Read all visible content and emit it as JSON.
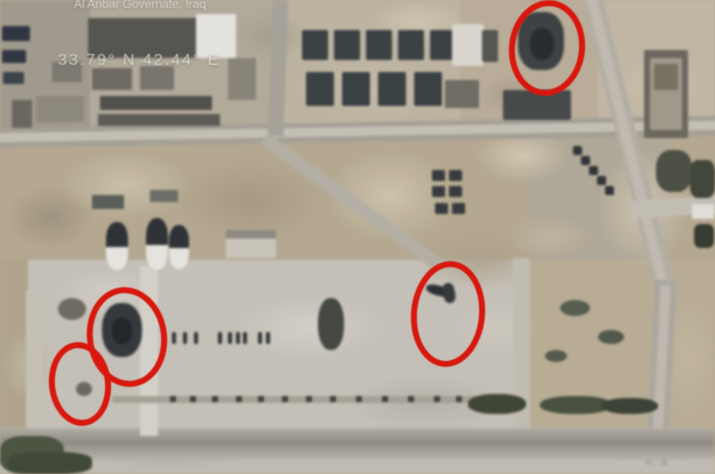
{
  "image": {
    "kind": "satellite-photo",
    "subject": "overhead view of an airbase with red circles marking damaged areas"
  },
  "overlay": {
    "location_caption": "Al Anbar Governate, Iraq",
    "coordinates_caption": "33.79° N 42.44° E"
  },
  "annotations": {
    "marker_shape": "ellipse",
    "marker_color": "#d8170e",
    "stroke_width_px": 6,
    "markers": [
      {
        "name": "strike-circle-top-right",
        "cx": 541,
        "cy": 42,
        "rx": 32,
        "ry": 42,
        "rotate_deg": 6
      },
      {
        "name": "strike-circle-left",
        "cx": 121,
        "cy": 331,
        "rx": 34,
        "ry": 44,
        "rotate_deg": -8
      },
      {
        "name": "strike-circle-bottom-left",
        "cx": 74,
        "cy": 378,
        "rx": 25,
        "ry": 36,
        "rotate_deg": -6
      },
      {
        "name": "strike-circle-center",
        "cx": 442,
        "cy": 308,
        "rx": 31,
        "ry": 47,
        "rotate_deg": 5
      }
    ]
  },
  "colors": {
    "annotation_red": "#d8170e",
    "terrain_tan": "#b7a98f",
    "concrete_gray": "#c7c2b8",
    "road_gray": "#a9a399",
    "building_dark": "#394042",
    "overlay_text": "#eae9e3"
  }
}
